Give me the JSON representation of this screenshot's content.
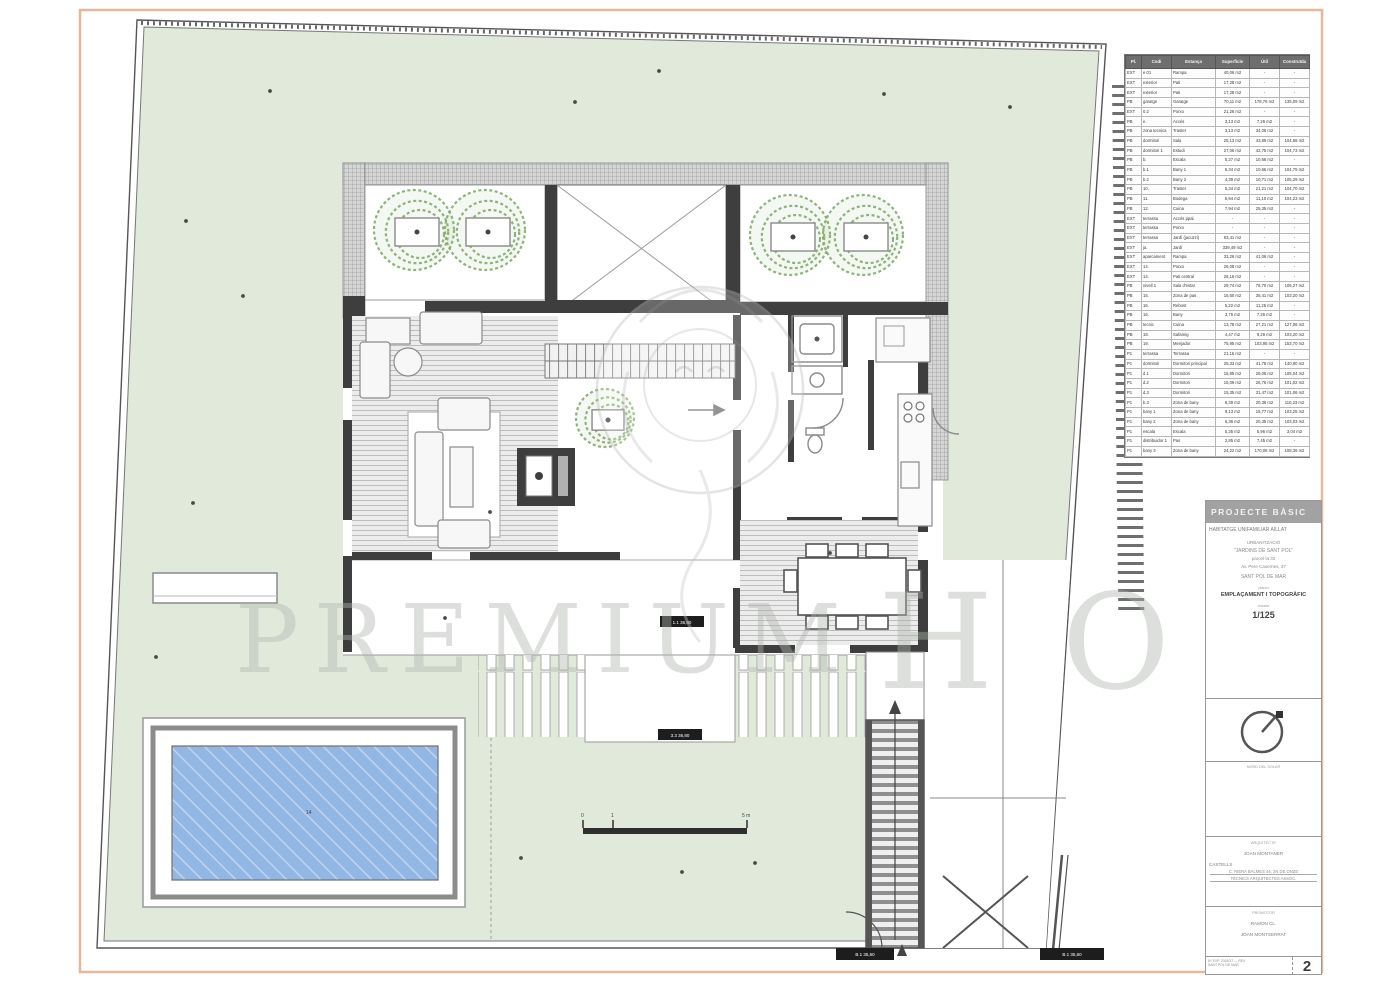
{
  "page": {
    "sheet_number": "2"
  },
  "watermark": {
    "left": "PREMIUM",
    "right": "HO"
  },
  "tags": {
    "terrace": "1.1 36,80",
    "walk": "3.3 36,80",
    "gate_left": "B.1 35,60",
    "gate_right": "B.1 35,60",
    "pool": "14"
  },
  "scale_bar": {
    "t0": "0",
    "t1": "1",
    "t5": "5 m"
  },
  "rooms_table": {
    "headers": [
      "Pl.",
      "Codi",
      "Estança",
      "Superfície",
      "Útil",
      "Construïda"
    ],
    "rows": [
      [
        "EXT",
        "e.01",
        "Rampa",
        "40,06 m2",
        "-",
        "-"
      ],
      [
        "EXT",
        "exterior",
        "Pati",
        "17,28 m2",
        "-",
        "-"
      ],
      [
        "EXT",
        "exterior",
        "Pati",
        "17,28 m2",
        "-",
        "-"
      ],
      [
        "PB",
        "garatge",
        "Garatge",
        "70,11 m2",
        "178,76 m2",
        "135,09 m2"
      ],
      [
        "EXT",
        "0.2",
        "Porxo",
        "21,26 m2",
        "-",
        "-"
      ],
      [
        "PB",
        "e.",
        "Accés",
        "3,13 m2",
        "7,26 m2",
        "-"
      ],
      [
        "PB",
        "zona tecnica",
        "Traster",
        "3,13 m2",
        "34,06 m2",
        "-"
      ],
      [
        "PB",
        "dormitori",
        "Sala",
        "25,13 m2",
        "43,89 m2",
        "104,68 m2"
      ],
      [
        "PB",
        "dormitori 1",
        "Estudi",
        "27,06 m2",
        "42,75 m2",
        "104,73 m2"
      ],
      [
        "PB",
        "b.",
        "Escala",
        "5,27 m2",
        "10,66 m2",
        "-"
      ],
      [
        "PB",
        "b.1",
        "Bany 1",
        "5,34 m2",
        "10,66 m2",
        "104,75 m2"
      ],
      [
        "PB",
        "b.2",
        "Bany 2",
        "4,39 m2",
        "10,71 m2",
        "105,29 m2"
      ],
      [
        "PB",
        "10.",
        "Traster",
        "5,34 m2",
        "21,21 m2",
        "104,70 m2"
      ],
      [
        "PB",
        "11.",
        "Bodega",
        "5,94 m2",
        "11,10 m2",
        "104,23 m2"
      ],
      [
        "PB",
        "12.",
        "Cuina",
        "7,94 m2",
        "25,35 m2",
        "-"
      ],
      [
        "EXT",
        "terrassa",
        "Accés ppal.",
        "-",
        "-",
        "-"
      ],
      [
        "EXT",
        "terrassa",
        "Porxo",
        "-",
        "-",
        "-"
      ],
      [
        "EXT",
        "terrassa",
        "Jardí (jacuzzi)",
        "93,41 m2",
        "-",
        "-"
      ],
      [
        "EXT",
        "ja.",
        "Jardí",
        "339,49 m2",
        "-",
        "-"
      ],
      [
        "EXT",
        "aparcament",
        "Rampa",
        "33,26 m2",
        "41,06 m2",
        "-"
      ],
      [
        "EXT",
        "14.",
        "Porxo",
        "26,08 m2",
        "-",
        "-"
      ],
      [
        "EXT",
        "14.",
        "Pati central",
        "26,16 m2",
        "-",
        "-"
      ],
      [
        "PB",
        "nivell 1",
        "Sala d'estar",
        "29,74 m2",
        "76,70 m2",
        "105,27 m2"
      ],
      [
        "PB",
        "15.",
        "Zona de pas",
        "15,60 m2",
        "36,41 m2",
        "103,20 m2"
      ],
      [
        "PB",
        "16.",
        "Rebost",
        "5,22 m2",
        "11,26 m2",
        "-"
      ],
      [
        "PB",
        "16.",
        "Bany",
        "3,75 m2",
        "7,26 m2",
        "-"
      ],
      [
        "PB",
        "tecnic",
        "Cuina",
        "13,78 m2",
        "27,21 m2",
        "127,06 m2"
      ],
      [
        "PB",
        "18.",
        "Safareig",
        "4,47 m2",
        "9,26 m2",
        "103,20 m2"
      ],
      [
        "PB",
        "19.",
        "Menjador",
        "75,95 m2",
        "103,95 m2",
        "153,70 m2"
      ],
      [
        "P1",
        "terrassa",
        "Terrassa",
        "21,16 m2",
        "-",
        "-"
      ],
      [
        "P1",
        "dormitori",
        "Dormitori principal",
        "25,33 m2",
        "41,78 m2",
        "140,90 m2"
      ],
      [
        "P1",
        "d.1",
        "Dormitori",
        "15,85 m2",
        "29,06 m2",
        "105,04 m2"
      ],
      [
        "P1",
        "d.2",
        "Dormitori",
        "15,09 m2",
        "26,76 m2",
        "101,02 m2"
      ],
      [
        "P1",
        "d.3",
        "Dormitori",
        "15,35 m2",
        "31,47 m2",
        "101,06 m2"
      ],
      [
        "P1",
        "b.3",
        "Zona de bany",
        "6,39 m2",
        "20,36 m2",
        "110,23 m2"
      ],
      [
        "P1",
        "bany 1",
        "Zona de bany",
        "9,13 m2",
        "15,77 m2",
        "103,25 m2"
      ],
      [
        "P1",
        "bany 2",
        "Zona de bany",
        "6,36 m2",
        "20,35 m2",
        "103,03 m2"
      ],
      [
        "P1",
        "escala",
        "Escala",
        "5,35 m2",
        "5,96 m2",
        "3,04 m2"
      ],
      [
        "P1",
        "distribuidor 1",
        "Pas",
        "2,85 m2",
        "7,45 m2",
        "-"
      ],
      [
        "P1",
        "bany 3",
        "Zona de bany",
        "24,22 m2",
        "170,06 m2",
        "108,36 m2"
      ]
    ]
  },
  "title_block": {
    "header": "PROJECTE BÀSIC",
    "client": "HABITATGE UNIFAMILIAR AÏLLAT",
    "urbanitzacio": "URBANITZACIÓ",
    "urbanitzacio_name": "\"JARDINS DE SANT POL\"",
    "parcela": "parcel·la 32",
    "address": "Av. Pere Casernes, 37",
    "city": "SANT POL DE MAR",
    "plan_label": "plànol",
    "plan_title": "EMPLAÇAMENT I TOPOGRÀFIC",
    "scale_label": "escala",
    "scale_value": "1/125",
    "north_caption": "NORD DEL SOLAR",
    "architect_label": "ARQUITECTE",
    "architect_name": "JOAN MONTANER",
    "architect_line1": "CASTELLS",
    "architect_line2": "C. RIERA BALMES 44, 2N DE ONZE",
    "architect_line3": "TÈCNICS ARQUITECTES ASSOC.",
    "promotor_label": "PROMOTOR",
    "promotor_name1": "RAMON CL.",
    "promotor_name2": "JOAN MONTSERRAT",
    "footer_line1": "Nº EXP. 2016/37 — REV",
    "footer_line2": "SANT POL DE MAR"
  },
  "colors": {
    "lawn": "#e1e9db",
    "pool_water": "#93b7e4",
    "wall": "#3e3e3e",
    "frame_orange": "#e6b79b"
  }
}
